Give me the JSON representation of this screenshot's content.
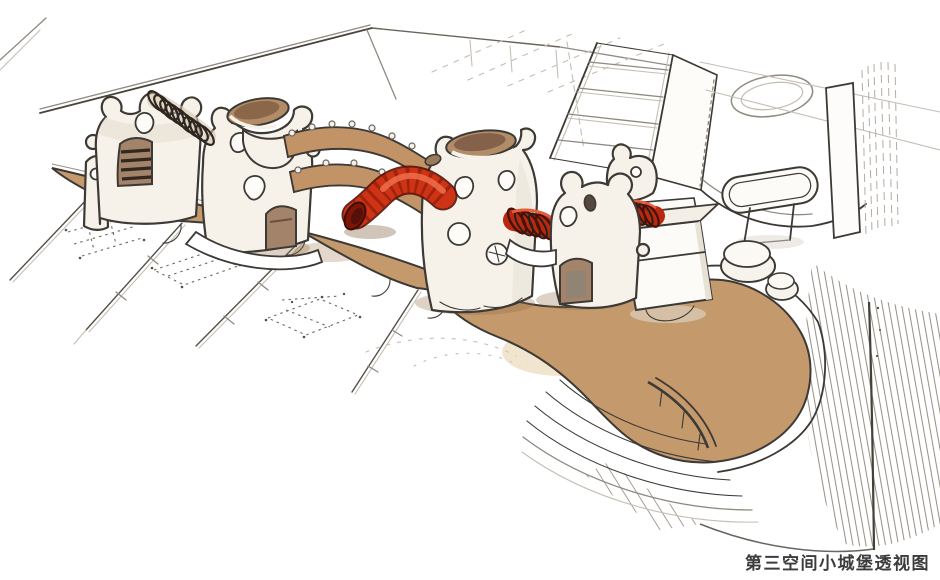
{
  "caption": {
    "text": "第三空间小城堡透视图"
  },
  "palette": {
    "ink": "#3d3935",
    "ink-light": "#8f8a81",
    "paper": "#ffffff",
    "wood": "#c49a6c",
    "wood-line": "#7a5f3f",
    "bridge-wood": "#c29367",
    "door-tan": "#a3836a",
    "tower-fill": "#f6f2ea",
    "red": "#cf3315",
    "red-dark": "#8e1d09",
    "red-highlight": "#ef6f4b",
    "coil-dark": "#2d2722",
    "hatch-line": "#938d83",
    "caption-color": "#3c3c3c"
  }
}
